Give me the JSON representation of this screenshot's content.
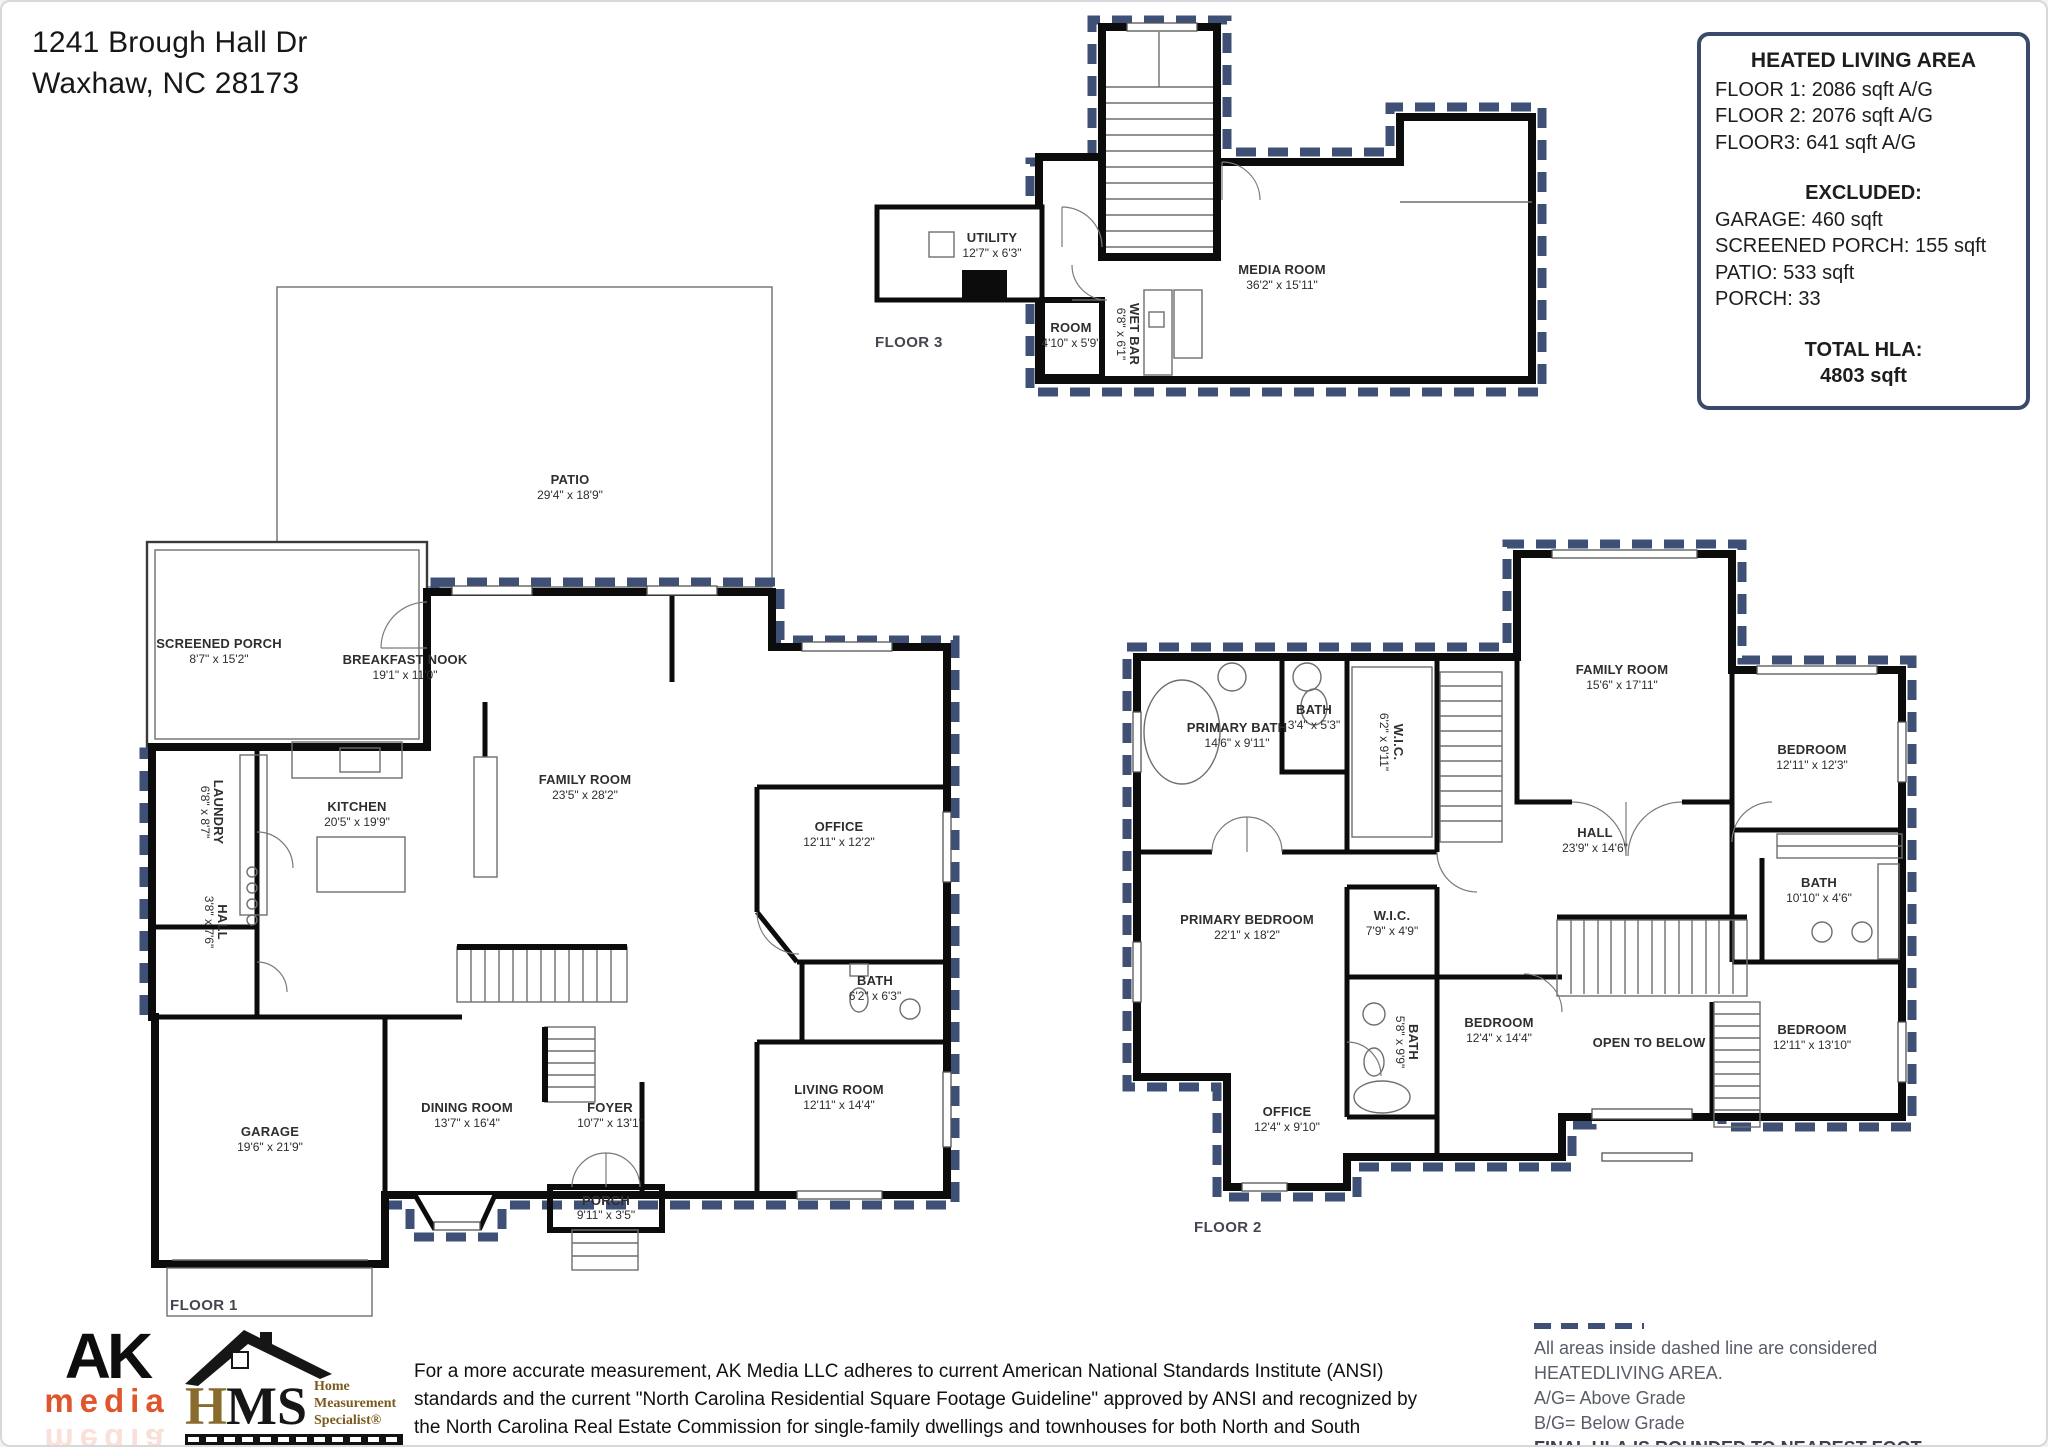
{
  "header": {
    "address_line1": "1241 Brough Hall Dr",
    "address_line2": "Waxhaw, NC  28173"
  },
  "hla_box": {
    "title": "HEATED LIVING AREA",
    "floor_lines": [
      "FLOOR 1: 2086 sqft  A/G",
      "FLOOR 2: 2076 sqft  A/G",
      "FLOOR3: 641 sqft A/G"
    ],
    "excluded_title": "EXCLUDED:",
    "excluded_lines": [
      "GARAGE: 460 sqft",
      "SCREENED PORCH: 155 sqft",
      "PATIO: 533 sqft",
      "PORCH: 33"
    ],
    "total_title": "TOTAL HLA:",
    "total_value": "4803 sqft"
  },
  "floor3": {
    "label": "FLOOR 3",
    "rooms": [
      {
        "name": "UTILITY",
        "dims": "12'7\" x 6'3\""
      },
      {
        "name": "ROOM",
        "dims": "4'10\" x 5'9\""
      },
      {
        "name": "WET BAR",
        "dims": "6'8\" x 6'1\""
      },
      {
        "name": "MEDIA ROOM",
        "dims": "36'2\" x 15'11\""
      }
    ]
  },
  "floor1": {
    "label": "FLOOR 1",
    "rooms": [
      {
        "name": "PATIO",
        "dims": "29'4\" x 18'9\""
      },
      {
        "name": "SCREENED PORCH",
        "dims": "8'7\" x 15'2\""
      },
      {
        "name": "BREAKFAST NOOK",
        "dims": "19'1\" x 11'0\""
      },
      {
        "name": "KITCHEN",
        "dims": "20'5\" x 19'9\""
      },
      {
        "name": "FAMILY ROOM",
        "dims": "23'5\" x 28'2\""
      },
      {
        "name": "LAUNDRY",
        "dims": "6'8\" x 8'7\""
      },
      {
        "name": "HALL",
        "dims": "3'8\" x 7'6\""
      },
      {
        "name": "OFFICE",
        "dims": "12'11\" x 12'2\""
      },
      {
        "name": "BATH",
        "dims": "6'2\" x 6'3\""
      },
      {
        "name": "GARAGE",
        "dims": "19'6\" x 21'9\""
      },
      {
        "name": "DINING ROOM",
        "dims": "13'7\" x 16'4\""
      },
      {
        "name": "FOYER",
        "dims": "10'7\" x 13'1\""
      },
      {
        "name": "LIVING ROOM",
        "dims": "12'11\" x 14'4\""
      },
      {
        "name": "PORCH",
        "dims": "9'11\" x 3'5\""
      }
    ]
  },
  "floor2": {
    "label": "FLOOR 2",
    "rooms": [
      {
        "name": "PRIMARY BATH",
        "dims": "14'6\" x 9'11\""
      },
      {
        "name": "BATH",
        "dims": "3'4\" x 5'3\""
      },
      {
        "name": "W.I.C.",
        "dims": "6'2\" x 9'11\""
      },
      {
        "name": "FAMILY ROOM",
        "dims": "15'6\" x 17'11\""
      },
      {
        "name": "BEDROOM",
        "dims": "12'11\" x 12'3\""
      },
      {
        "name": "HALL",
        "dims": "23'9\" x 14'6\""
      },
      {
        "name": "BATH",
        "dims": "10'10\" x 4'6\""
      },
      {
        "name": "PRIMARY BEDROOM",
        "dims": "22'1\" x 18'2\""
      },
      {
        "name": "W.I.C.",
        "dims": "7'9\" x 4'9\""
      },
      {
        "name": "BATH",
        "dims": "5'8\" x 9'9\""
      },
      {
        "name": "BEDROOM",
        "dims": "12'4\" x 14'4\""
      },
      {
        "name": "OFFICE",
        "dims": "12'4\" x 9'10\""
      },
      {
        "name": "OPEN TO BELOW",
        "dims": ""
      },
      {
        "name": "BEDROOM",
        "dims": "12'11\" x 13'10\""
      }
    ]
  },
  "footer": {
    "logo_ak": {
      "top": "AK",
      "bottom": "media"
    },
    "logo_hms": {
      "h": "H",
      "ms": "MS",
      "line1": "Home",
      "line2": "Measurement",
      "line3": "Specialist®"
    },
    "disclaimer": "For a more accurate measurement, AK Media LLC adheres to current American National Standards Institute (ANSI) standards and the current \"North Carolina Residential Square Footage Guideline\" approved by ANSI and recognized by the North Carolina Real Estate Commission for single-family dwellings and townhouses for both North and South Carolina.",
    "legend": {
      "line1": "All areas inside dashed line are considered HEATEDLIVING AREA.",
      "line2": "A/G= Above Grade",
      "line3": "B/G= Below Grade",
      "line4": "FINAL HLA IS ROUNDED TO NEAREST FOOT"
    }
  },
  "colors": {
    "dash": "#3e5075",
    "wall": "#0c0c0c",
    "hla_border": "#3a4a68",
    "ak_orange": "#e0552b",
    "hms_gold": "#8a6b2e",
    "hms_brown": "#7a5a1e"
  }
}
